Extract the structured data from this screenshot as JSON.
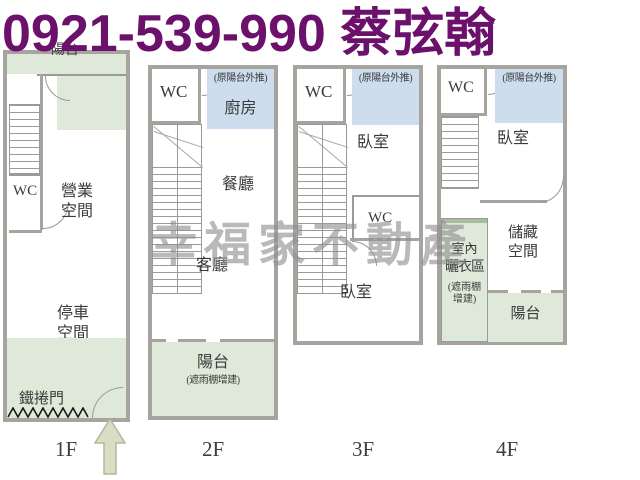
{
  "header": {
    "phone": "0921-539-990",
    "agent": "蔡弦翰"
  },
  "watermark": "幸福家不動產",
  "colors": {
    "header_text": "#6b116b",
    "area_green": "#dfe9d9",
    "area_blue": "#cddded",
    "wall_gray": "#a7a4a0",
    "watermark_gray": "#8f8f8f"
  },
  "floors": [
    {
      "label": "1F",
      "rooms": {
        "balcony": "陽台",
        "wc": "WC",
        "business": "營業空間",
        "parking": "停車空間",
        "roller_door": "鐵捲門"
      }
    },
    {
      "label": "2F",
      "rooms": {
        "wc": "WC",
        "pushed_out_note": "(原陽台外推)",
        "kitchen": "廚房",
        "dining": "餐廳",
        "living": "客廳",
        "balcony": "陽台",
        "balcony_note": "(遮雨棚增建)"
      }
    },
    {
      "label": "3F",
      "rooms": {
        "wc_top": "WC",
        "pushed_out_note": "(原陽台外推)",
        "bedroom_front": "臥室",
        "wc_mid": "WC",
        "bedroom_back": "臥室"
      }
    },
    {
      "label": "4F",
      "rooms": {
        "wc": "WC",
        "pushed_out_note": "(原陽台外推)",
        "bedroom": "臥室",
        "storage": "儲藏空間",
        "drying_1": "室內",
        "drying_2": "曬衣區",
        "drying_note_1": "(遮雨棚",
        "drying_note_2": "增建)",
        "balcony": "陽台"
      }
    }
  ]
}
